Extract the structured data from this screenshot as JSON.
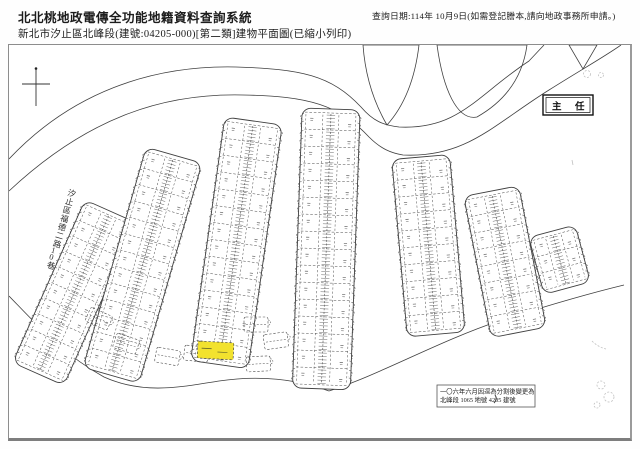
{
  "header": {
    "title": "北北桃地政電傳全功能地籍資料查詢系統",
    "query_date": "查詢日期:114年 10月9日(如需登記謄本,請向地政事務所申請。)",
    "subtitle": "新北市汐止區北峰段(建號:04205-000)[第二類]建物平面圖(已縮小列印)"
  },
  "map": {
    "street_label": "汐止區福德二路10巷",
    "stamp_text": "主任",
    "note": {
      "line1": "一〇六年六月因逕為分割後變更為",
      "line2": "北峰段 1065 地號 4205 建號"
    },
    "colors": {
      "solid": "#3f3f3f",
      "dash": "#4a4a4a",
      "tick": "#5a5a5a",
      "glyph": "#787878",
      "faint": "#c0c0c0",
      "highlight": "#f2e22e",
      "stamp": "#111111"
    }
  }
}
